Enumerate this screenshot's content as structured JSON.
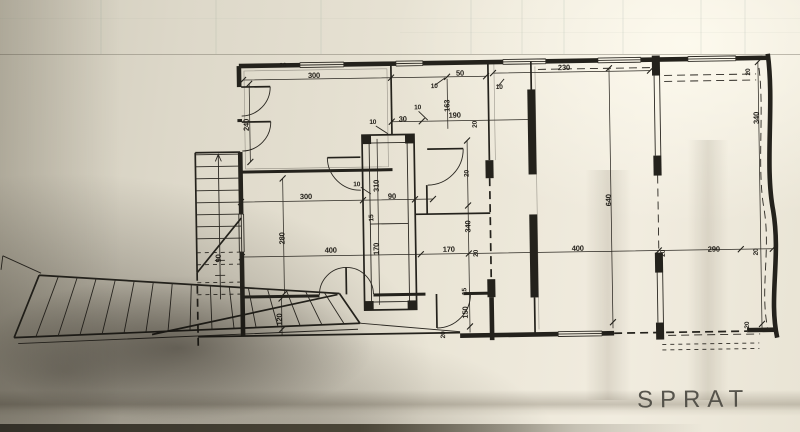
{
  "title": {
    "label": "SPRAT"
  },
  "colors": {
    "ink": "#24221c",
    "paper_light": "#f1ecdf",
    "paper_mid": "#ddd8c9",
    "paper_shadow": "#3f3a30",
    "dim_text": "#221f19",
    "title_text": "#48463f"
  },
  "plan": {
    "type": "architectural-floor-plan",
    "storey_label": "SPRAT",
    "dims": [
      {
        "v": "300"
      },
      {
        "v": "50"
      },
      {
        "v": "10"
      },
      {
        "v": "10"
      },
      {
        "v": "230"
      },
      {
        "v": "20"
      },
      {
        "v": "240"
      },
      {
        "v": "163"
      },
      {
        "v": "10"
      },
      {
        "v": "30"
      },
      {
        "v": "10"
      },
      {
        "v": "190"
      },
      {
        "v": "20"
      },
      {
        "v": "310"
      },
      {
        "v": "10"
      },
      {
        "v": "90"
      },
      {
        "v": "300"
      },
      {
        "v": "280"
      },
      {
        "v": "90"
      },
      {
        "v": "15"
      },
      {
        "v": "20"
      },
      {
        "v": "340"
      },
      {
        "v": "170"
      },
      {
        "v": "400"
      },
      {
        "v": "170"
      },
      {
        "v": "20"
      },
      {
        "v": "400"
      },
      {
        "v": "20"
      },
      {
        "v": "290"
      },
      {
        "v": "20"
      },
      {
        "v": "120"
      },
      {
        "v": "15"
      },
      {
        "v": "150"
      },
      {
        "v": "20"
      },
      {
        "v": "640"
      },
      {
        "v": "20"
      },
      {
        "v": "340"
      },
      {
        "v": "20"
      }
    ]
  }
}
